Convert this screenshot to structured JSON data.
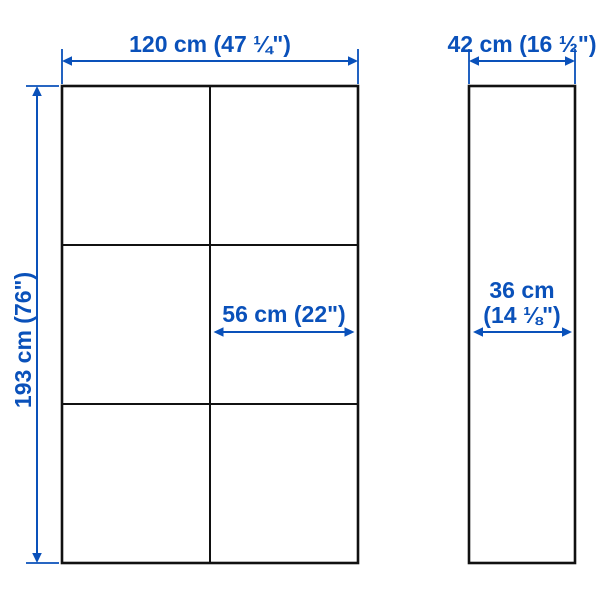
{
  "diagram": {
    "type": "furniture-dimension-diagram",
    "colors": {
      "dimension_blue": "#0a51ba",
      "outline_black": "#111111",
      "background": "#ffffff"
    },
    "front_view": {
      "grid_columns": 2,
      "grid_rows": 3,
      "width_label": "120 cm (47 ¼\")",
      "height_label": "193 cm (76\")",
      "inner_width_label": "56 cm (22\")"
    },
    "side_view": {
      "width_label": "42 cm (16 ½\")",
      "depth_label_line1": "36 cm",
      "depth_label_line2": "(14 ⅛\")"
    }
  }
}
